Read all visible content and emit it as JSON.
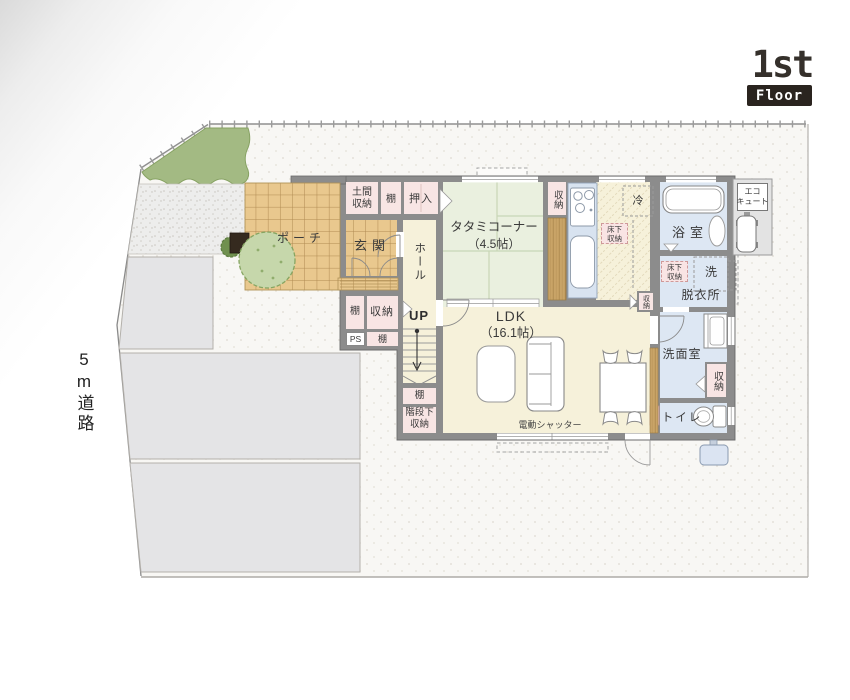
{
  "logo": {
    "floor_number": "1st",
    "floor_word": "Floor"
  },
  "site": {
    "road_label": "5m道路"
  },
  "plan": {
    "porch": "ポーチ",
    "entrance": "玄関",
    "doma_storage": {
      "line1": "土間",
      "line2": "収納"
    },
    "shelf_entry": "棚",
    "closet_oshiire": "押入",
    "tatami": {
      "name": "タタミコーナー",
      "size": "（4.5帖）"
    },
    "pantry_storage": "収納",
    "fridge": "冷",
    "underfloor_kitchen": {
      "line1": "床下",
      "line2": "収納"
    },
    "ecocute": {
      "line1": "エコ",
      "line2": "キュート"
    },
    "bathroom": "浴室",
    "underfloor_dressing": {
      "line1": "床下",
      "line2": "収納"
    },
    "washer": "洗",
    "dressing_room": "脱衣所",
    "hall": "ホール",
    "shelf_west": "棚",
    "storage_west": "収納",
    "pipe_space": "PS",
    "shelf_west_lower": "棚",
    "stairs_up": "UP",
    "ldk": {
      "name": "LDK",
      "size": "（16.1帖）"
    },
    "shelf_under_stairs": "棚",
    "under_stairs_storage": {
      "line1": "階段下",
      "line2": "収納"
    },
    "washroom": "洗面室",
    "storage_washroom": "収納",
    "toilet": "トイレ",
    "storage_ldk": "収納",
    "electric_shutter": "電動シャッター"
  },
  "palette": {
    "wall": "#8c8c8c",
    "floor_cream": "#f6f1da",
    "tatami_green": "#eaf0df",
    "storage_pink": "#f8e5e4",
    "wet_blue": "#dde7f3",
    "tile_tan": "#e9c88e",
    "wood": "#c9a467",
    "lawn_green": "#a3ba83",
    "tree_green": "#c6d7ab",
    "gravel": "#ededec",
    "driveway": "#e4e4e6",
    "badge_dark": "#2a241f"
  }
}
